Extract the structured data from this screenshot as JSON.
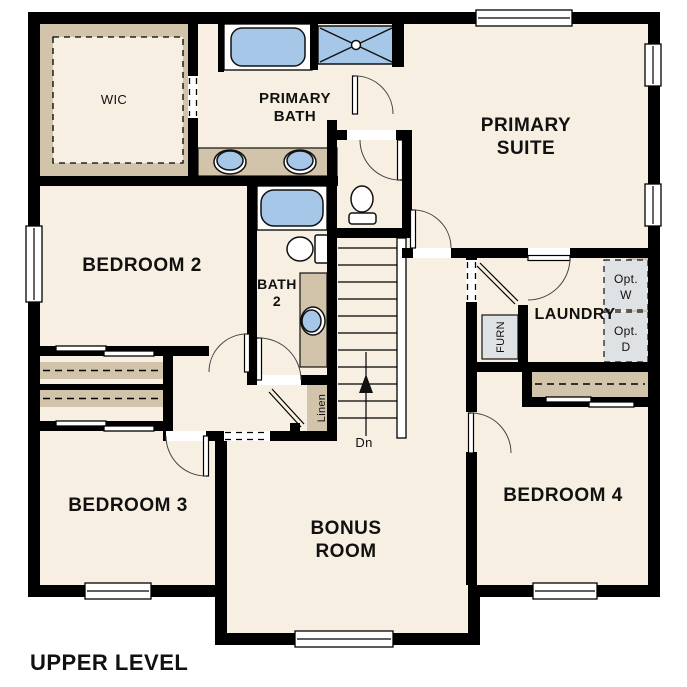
{
  "plan": {
    "type": "floor-plan",
    "title": "UPPER LEVEL",
    "labels": {
      "wic": "WIC",
      "primary_bath_1": "PRIMARY",
      "primary_bath_2": "BATH",
      "primary_suite_1": "PRIMARY",
      "primary_suite_2": "SUITE",
      "bedroom2": "BEDROOM 2",
      "bath2_1": "BATH",
      "bath2_2": "2",
      "laundry": "LAUNDRY",
      "bedroom3": "BEDROOM 3",
      "bonus_1": "BONUS",
      "bonus_2": "ROOM",
      "bedroom4": "BEDROOM 4",
      "linen": "Linen",
      "furnace": "FURN",
      "opt_w_1": "Opt.",
      "opt_w_2": "W",
      "opt_d_1": "Opt.",
      "opt_d_2": "D",
      "down": "Dn"
    },
    "colors": {
      "paper": "#ffffff",
      "floor": "#f7efe1",
      "wall": "#000000",
      "casework": "#d2c4ab",
      "fixture": "#a6c7e7",
      "equipment": "#dfe2e4"
    }
  }
}
